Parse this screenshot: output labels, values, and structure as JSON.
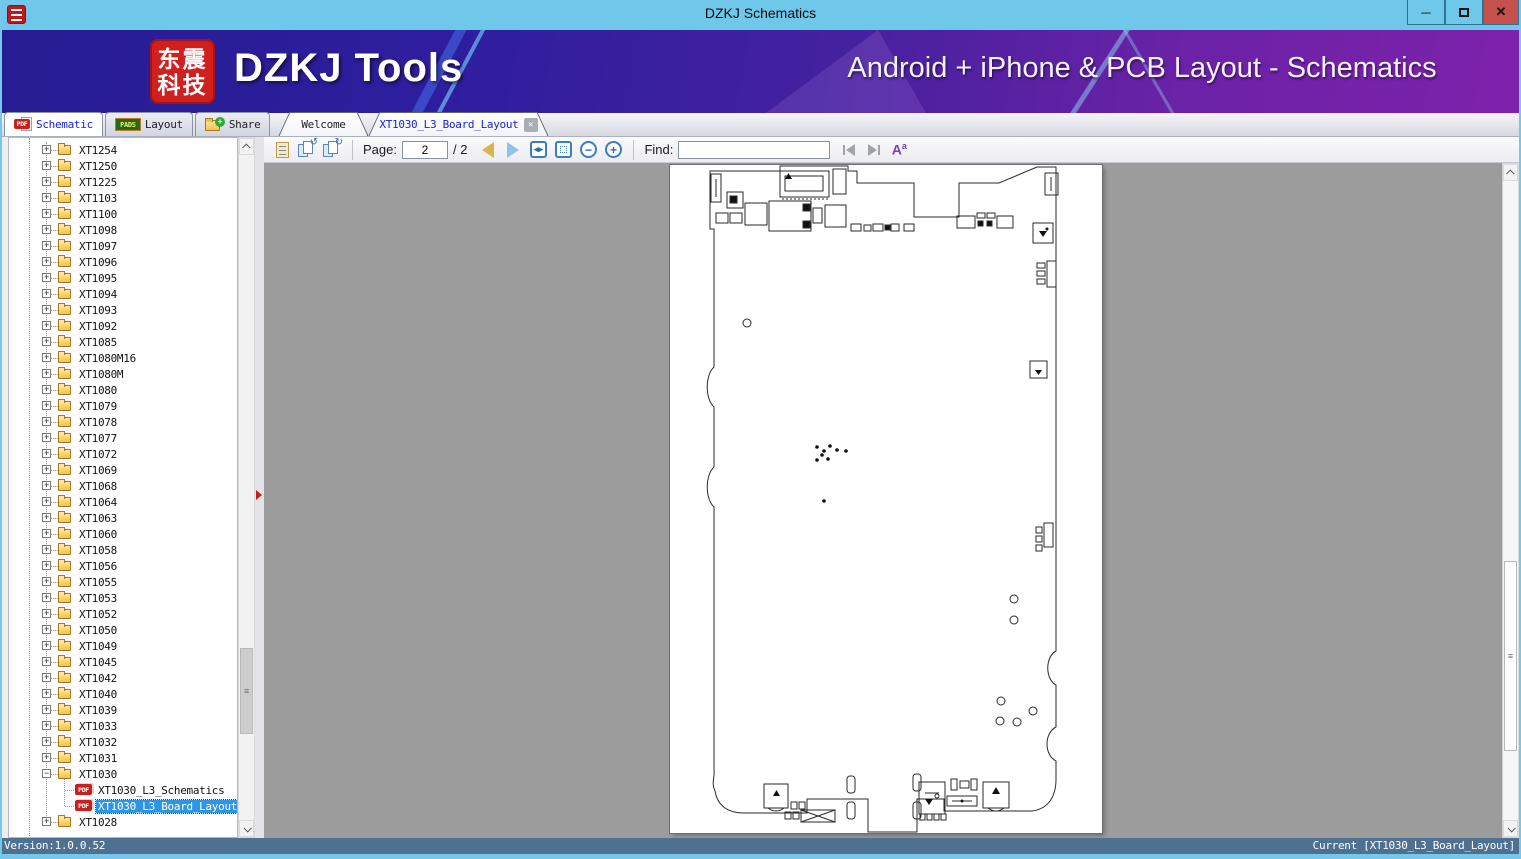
{
  "window": {
    "title": "DZKJ Schematics",
    "status_left": "Version:1.0.0.52",
    "status_right": "Current [XT1030_L3_Board_Layout]"
  },
  "icons": {
    "minimize": "─",
    "close": "✕",
    "pdf_badge": "PDF",
    "pads_badge": "PADS",
    "share_plus": "+",
    "rotate_left": "↺",
    "rotate_right": "↻",
    "zoom_out": "−",
    "zoom_in": "+",
    "fit_width": "◂▸",
    "match_case_A": "A",
    "match_case_a": "a",
    "grip": "≡"
  },
  "header": {
    "logo_line1": "东震",
    "logo_line2": "科技",
    "brand": "DZKJ Tools",
    "tagline": "Android + iPhone & PCB Layout - Schematics"
  },
  "main_tabs": [
    {
      "label": "Schematic",
      "icon": "pdf-icon",
      "active": true
    },
    {
      "label": "Layout",
      "icon": "pads-icon",
      "active": false
    },
    {
      "label": "Share",
      "icon": "share-icon",
      "active": false
    }
  ],
  "doc_tabs": [
    {
      "label": "Welcome",
      "active": false
    },
    {
      "label": "XT1030_L3_Board_Layout",
      "active": true,
      "closable": true
    }
  ],
  "toolbar": {
    "page_label": "Page:",
    "page_value": "2",
    "page_total": "/ 2",
    "find_label": "Find:",
    "find_value": ""
  },
  "tree": {
    "items": [
      {
        "label": "XT1254",
        "type": "folder",
        "expand": "+"
      },
      {
        "label": "XT1250",
        "type": "folder",
        "expand": "+"
      },
      {
        "label": "XT1225",
        "type": "folder",
        "expand": "+"
      },
      {
        "label": "XT1103",
        "type": "folder",
        "expand": "+"
      },
      {
        "label": "XT1100",
        "type": "folder",
        "expand": "+"
      },
      {
        "label": "XT1098",
        "type": "folder",
        "expand": "+"
      },
      {
        "label": "XT1097",
        "type": "folder",
        "expand": "+"
      },
      {
        "label": "XT1096",
        "type": "folder",
        "expand": "+"
      },
      {
        "label": "XT1095",
        "type": "folder",
        "expand": "+"
      },
      {
        "label": "XT1094",
        "type": "folder",
        "expand": "+"
      },
      {
        "label": "XT1093",
        "type": "folder",
        "expand": "+"
      },
      {
        "label": "XT1092",
        "type": "folder",
        "expand": "+"
      },
      {
        "label": "XT1085",
        "type": "folder",
        "expand": "+"
      },
      {
        "label": "XT1080M16",
        "type": "folder",
        "expand": "+"
      },
      {
        "label": "XT1080M",
        "type": "folder",
        "expand": "+"
      },
      {
        "label": "XT1080",
        "type": "folder",
        "expand": "+"
      },
      {
        "label": "XT1079",
        "type": "folder",
        "expand": "+"
      },
      {
        "label": "XT1078",
        "type": "folder",
        "expand": "+"
      },
      {
        "label": "XT1077",
        "type": "folder",
        "expand": "+"
      },
      {
        "label": "XT1072",
        "type": "folder",
        "expand": "+"
      },
      {
        "label": "XT1069",
        "type": "folder",
        "expand": "+"
      },
      {
        "label": "XT1068",
        "type": "folder",
        "expand": "+"
      },
      {
        "label": "XT1064",
        "type": "folder",
        "expand": "+"
      },
      {
        "label": "XT1063",
        "type": "folder",
        "expand": "+"
      },
      {
        "label": "XT1060",
        "type": "folder",
        "expand": "+"
      },
      {
        "label": "XT1058",
        "type": "folder",
        "expand": "+"
      },
      {
        "label": "XT1056",
        "type": "folder",
        "expand": "+"
      },
      {
        "label": "XT1055",
        "type": "folder",
        "expand": "+"
      },
      {
        "label": "XT1053",
        "type": "folder",
        "expand": "+"
      },
      {
        "label": "XT1052",
        "type": "folder",
        "expand": "+"
      },
      {
        "label": "XT1050",
        "type": "folder",
        "expand": "+"
      },
      {
        "label": "XT1049",
        "type": "folder",
        "expand": "+"
      },
      {
        "label": "XT1045",
        "type": "folder",
        "expand": "+"
      },
      {
        "label": "XT1042",
        "type": "folder",
        "expand": "+"
      },
      {
        "label": "XT1040",
        "type": "folder",
        "expand": "+"
      },
      {
        "label": "XT1039",
        "type": "folder",
        "expand": "+"
      },
      {
        "label": "XT1033",
        "type": "folder",
        "expand": "+"
      },
      {
        "label": "XT1032",
        "type": "folder",
        "expand": "+"
      },
      {
        "label": "XT1031",
        "type": "folder",
        "expand": "+"
      },
      {
        "label": "XT1030",
        "type": "folder",
        "expand": "-"
      },
      {
        "label": "XT1030_L3_Schematics",
        "type": "pdf"
      },
      {
        "label": "XT1030_L3_Board_Layout",
        "type": "pdf",
        "selected": true
      },
      {
        "label": "XT1028",
        "type": "folder",
        "expand": "+"
      }
    ]
  },
  "colors": {
    "titlebar": "#6FC7E9",
    "close_button": "#C5514E",
    "header_left": "#271C92",
    "header_right": "#7E22AC",
    "logo_red": "#D01F1F",
    "selection_blue": "#2E95E5",
    "viewer_gray": "#9C9C9C",
    "statusbar": "#4E7191",
    "frame_blue": "#76C8EA",
    "active_tab_text": "#1724D8"
  }
}
